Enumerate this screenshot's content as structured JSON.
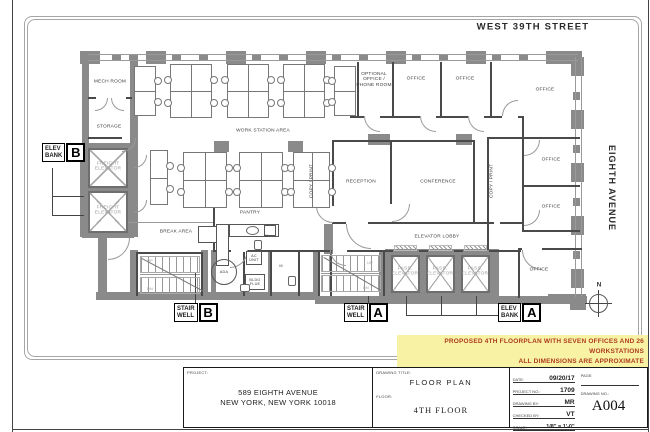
{
  "street": {
    "top": "WEST 39TH STREET",
    "right": "EIGHTH AVENUE",
    "north": "N"
  },
  "plan": {
    "labels": [
      {
        "text": "MECH ROOM"
      },
      {
        "text": "STORAGE"
      },
      {
        "text": "FREIGHT\nELEVATOR"
      },
      {
        "text": "FREIGHT\nELEVATOR"
      },
      {
        "text": "WORK STATION AREA"
      },
      {
        "text": "COPY / PRINT"
      },
      {
        "text": "PANTRY"
      },
      {
        "text": "BREAK AREA"
      },
      {
        "text": "OPTIONAL\nOFFICE /\nPHONE ROOM"
      },
      {
        "text": "OFFICE"
      },
      {
        "text": "OFFICE"
      },
      {
        "text": "OFFICE"
      },
      {
        "text": "OFFICE"
      },
      {
        "text": "OFFICE"
      },
      {
        "text": "OFFICE"
      },
      {
        "text": "RECEPTION"
      },
      {
        "text": "CONFERENCE"
      },
      {
        "text": "COPY / PRINT"
      },
      {
        "text": "ELEVATOR LOBBY"
      },
      {
        "text": "PASS.\nELEVATOR"
      },
      {
        "text": "PASS.\nELEVATOR"
      },
      {
        "text": "PASS.\nELEVATOR"
      },
      {
        "text": "ADA"
      },
      {
        "text": "AC\nUNIT"
      },
      {
        "text": "BLDG\nFLUE"
      },
      {
        "text": "UP"
      },
      {
        "text": "DN"
      },
      {
        "text": "UP"
      },
      {
        "text": "DN"
      },
      {
        "text": "W"
      },
      {
        "text": "M"
      }
    ],
    "badges": [
      {
        "text": "ELEV\nBANK",
        "letter": "B"
      },
      {
        "text": "STAIR\nWELL",
        "letter": "B"
      },
      {
        "text": "STAIR\nWELL",
        "letter": "A"
      },
      {
        "text": "ELEV\nBANK",
        "letter": "A"
      }
    ]
  },
  "note": {
    "lines": [
      "PROPOSED 4TH FLOORPLAN WITH SEVEN OFFICES AND 26 WORKSTATIONS",
      "ALL DIMENSIONS ARE APPROXIMATE",
      "FURNITURE SHOWN IS FOR ILLUSTRATIVE PURPOSES ONLY"
    ],
    "highlight": "#f8f3a4",
    "text_color": "#ae3b1e"
  },
  "titleblock": {
    "project_label": "PROJECT:",
    "project_name": "589 EIGHTH AVENUE",
    "project_address": "NEW YORK, NEW YORK 10018",
    "drawing_title_label": "DRAWING TITLE:",
    "drawing_title": "FLOOR PLAN",
    "floor_label": "FLOOR:",
    "floor_value": "4TH FLOOR",
    "fields": [
      {
        "label": "DATE:",
        "value": "09/20/17"
      },
      {
        "label": "PROJECT NO.:",
        "value": "1709"
      },
      {
        "label": "DRAWING BY:",
        "value": "MR"
      },
      {
        "label": "CHECKED BY:",
        "value": "VT"
      },
      {
        "label": "SCALE:",
        "value": "1/8\" = 1'-0\""
      }
    ],
    "page_label": "PAGE:",
    "drawing_no_label": "DRAWING NO.:",
    "drawing_no": "A004"
  }
}
